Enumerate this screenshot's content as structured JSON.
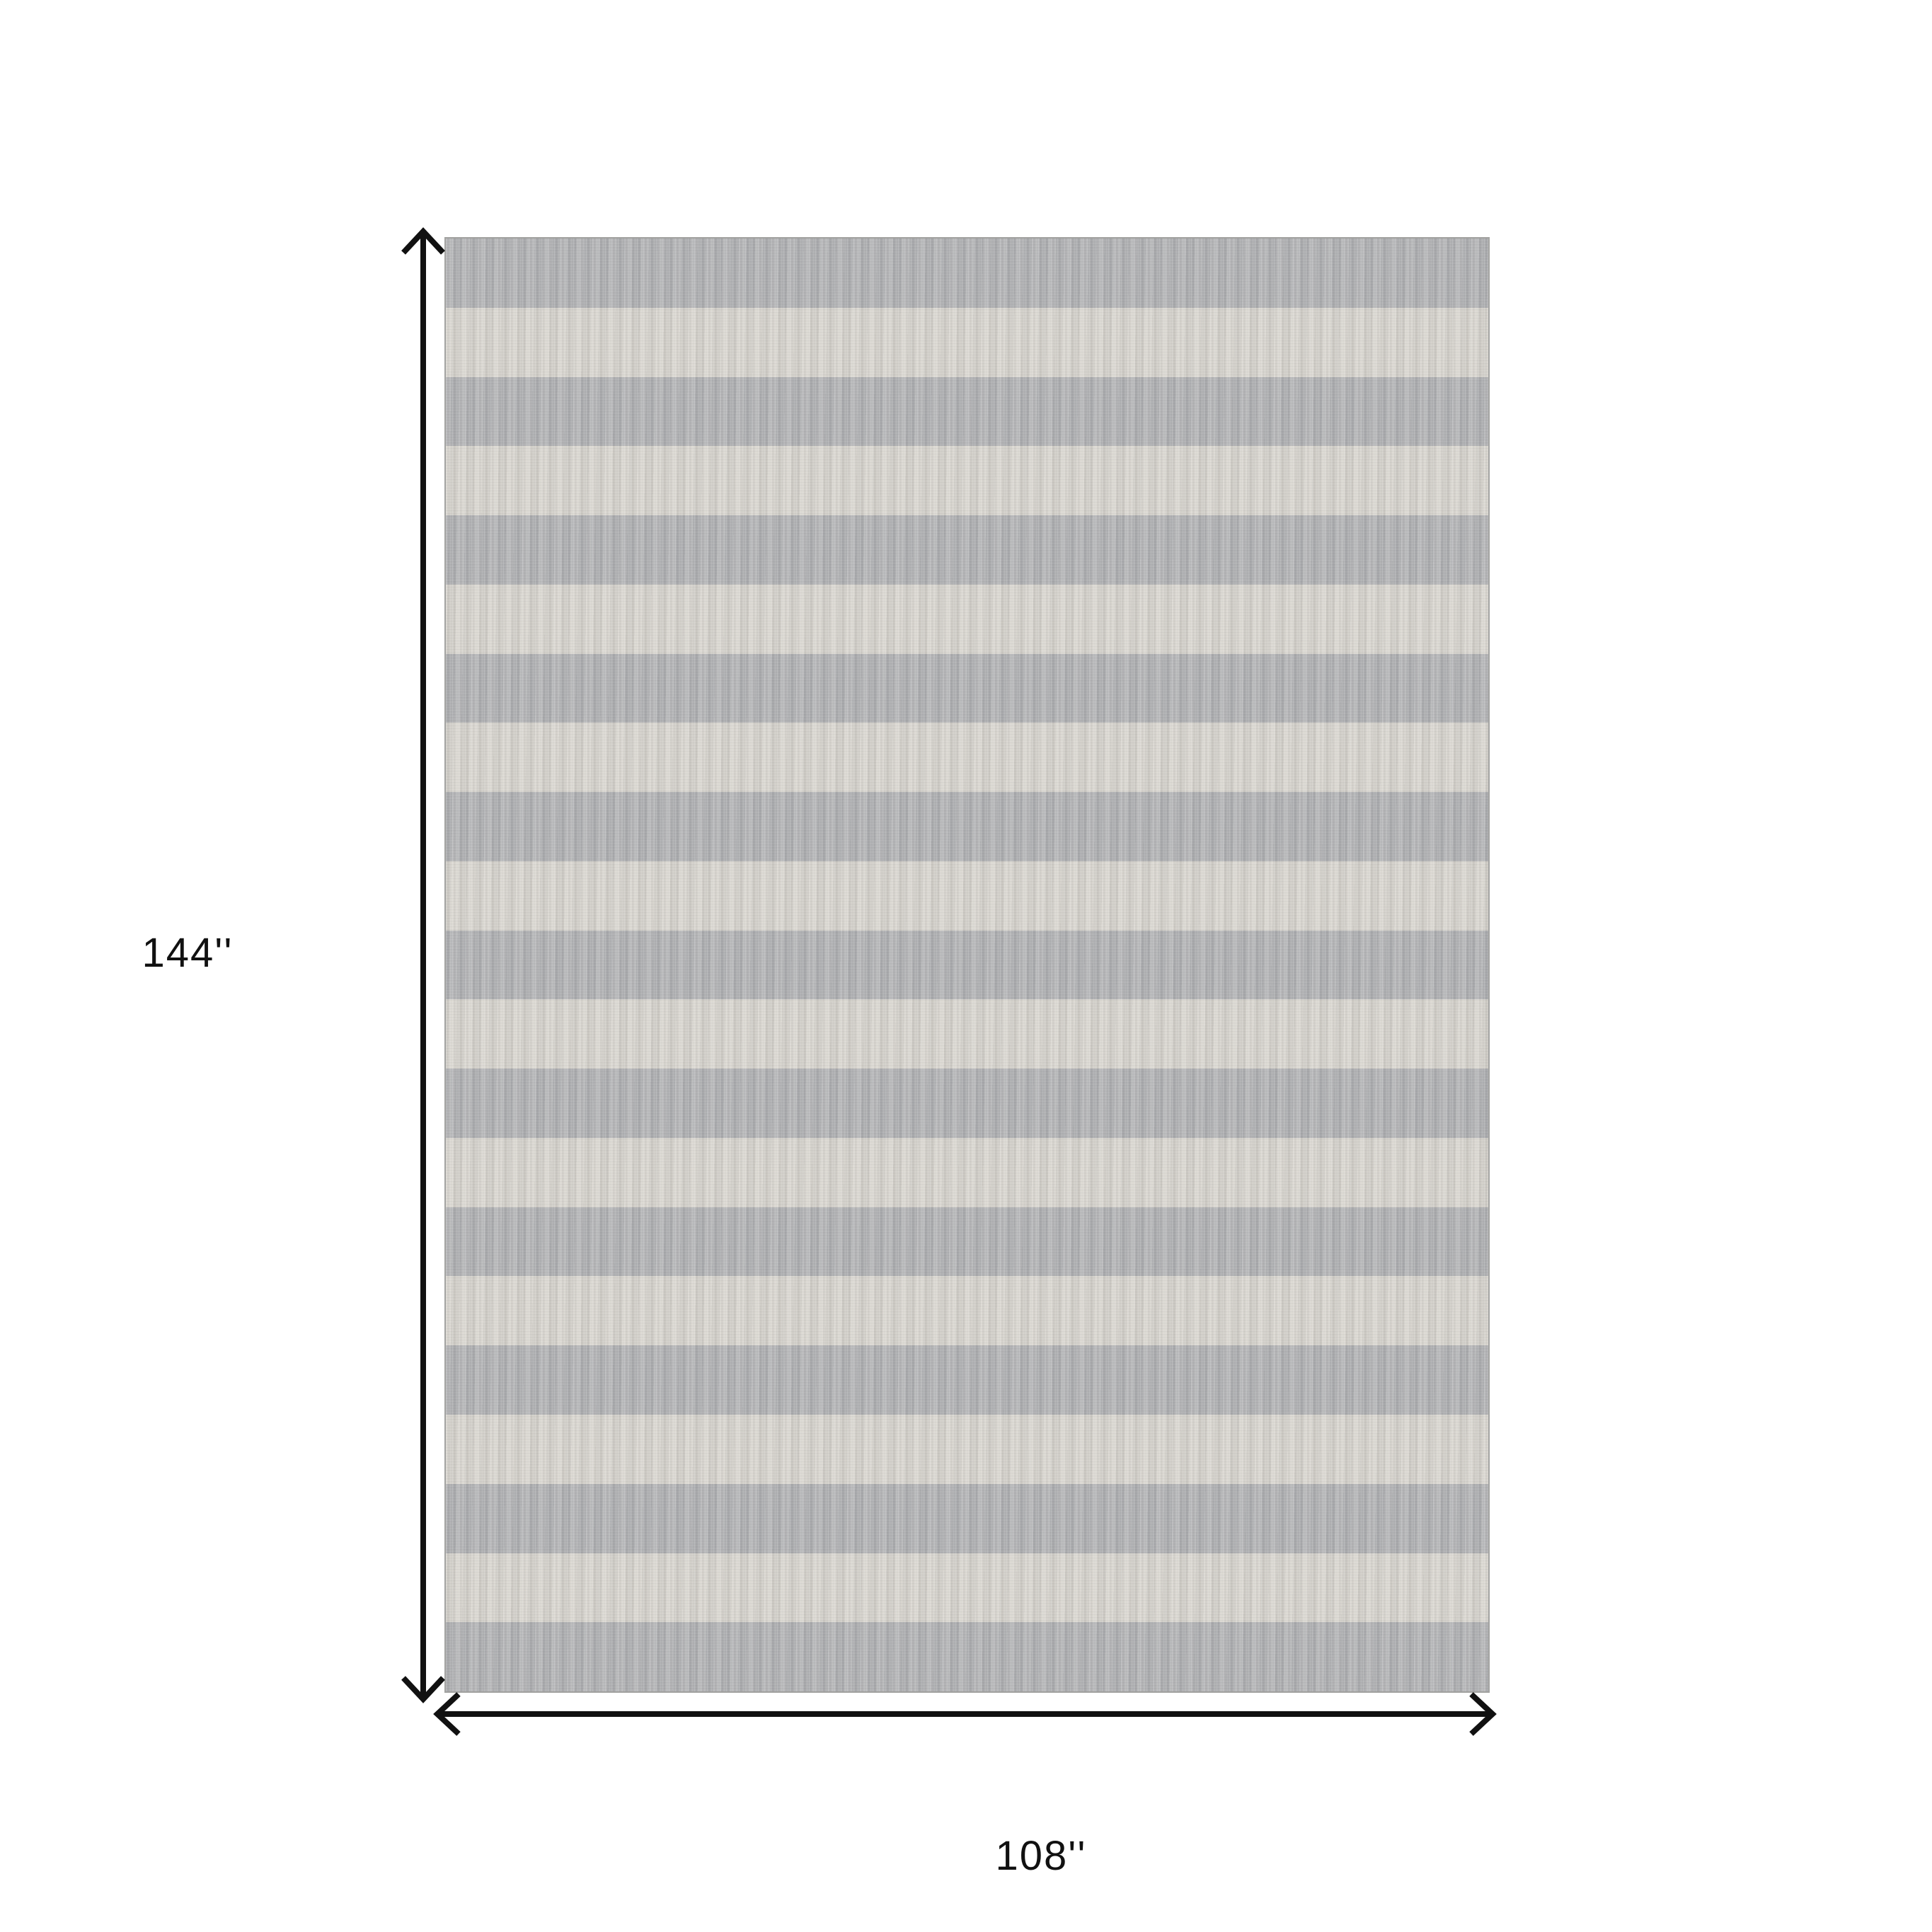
{
  "diagram": {
    "type": "product-dimension-diagram",
    "product": "striped area rug",
    "height_label": "144''",
    "width_label": "108''",
    "arrow_color": "#111111",
    "label_color": "#111111",
    "background": "#ffffff"
  },
  "rug": {
    "stripe_count": 21,
    "first_stripe": "gray",
    "stripe_orientation": "horizontal",
    "colors": {
      "gray_stripe": "#b0b1b3",
      "cream_stripe": "#d7d4cd",
      "edge_band": "#c6c6c4",
      "seam_line": "#85868a",
      "outer_edge": "#a3a3a1"
    }
  }
}
